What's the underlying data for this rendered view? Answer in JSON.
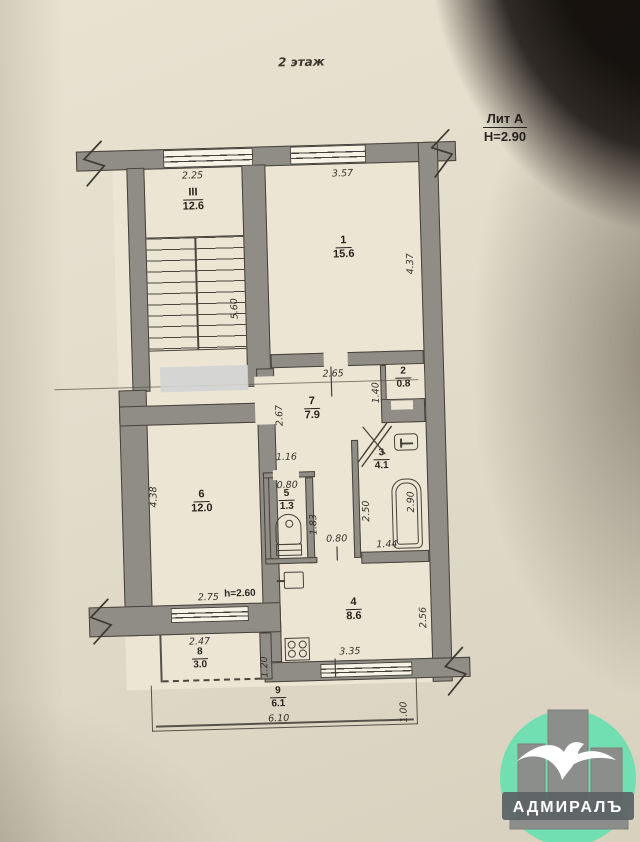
{
  "page": {
    "title": "2 этаж",
    "liter": "Лит А",
    "height_note": "H=2.90"
  },
  "rooms": [
    {
      "number": "III",
      "area": "12.6"
    },
    {
      "number": "1",
      "area": "15.6"
    },
    {
      "number": "2",
      "area": "0.8"
    },
    {
      "number": "3",
      "area": "4.1"
    },
    {
      "number": "4",
      "area": "8.6"
    },
    {
      "number": "5",
      "area": "1.3"
    },
    {
      "number": "6",
      "area": "12.0"
    },
    {
      "number": "7",
      "area": "7.9"
    },
    {
      "number": "8",
      "area": "3.0"
    },
    {
      "number": "9",
      "area": "6.1"
    }
  ],
  "dimensions": {
    "stair_width": "2.25",
    "stair_depth": "5.60",
    "room1_width": "3.57",
    "room1_depth": "4.37",
    "hall_width": "2.65",
    "hall_depth": "2.67",
    "closet_height": "1.40",
    "wc_block_width": "1.16",
    "wc_width": "0.80",
    "wc_depth": "1.83",
    "bath_depth_left": "2.50",
    "bath_depth_right": "2.90",
    "bath_width": "1.44",
    "passage_width": "0.80",
    "room6_depth": "4.38",
    "room6_window": "2.75",
    "ceiling_height": "h=2.60",
    "room8_width": "2.47",
    "room8_depth": "1.20",
    "kitchen_depth": "2.56",
    "kitchen_window": "3.35",
    "balcony_length": "6.10",
    "balcony_width": "1.00"
  },
  "watermark": {
    "text": "АДМИРАЛЪ"
  },
  "colors": {
    "paper": "#e6dfcd",
    "wall": "#8f8d85",
    "line": "#45423a",
    "logo_mint": "#72dfb2",
    "logo_gray": "#8c8e8c",
    "redaction": "#d3d5d2"
  }
}
